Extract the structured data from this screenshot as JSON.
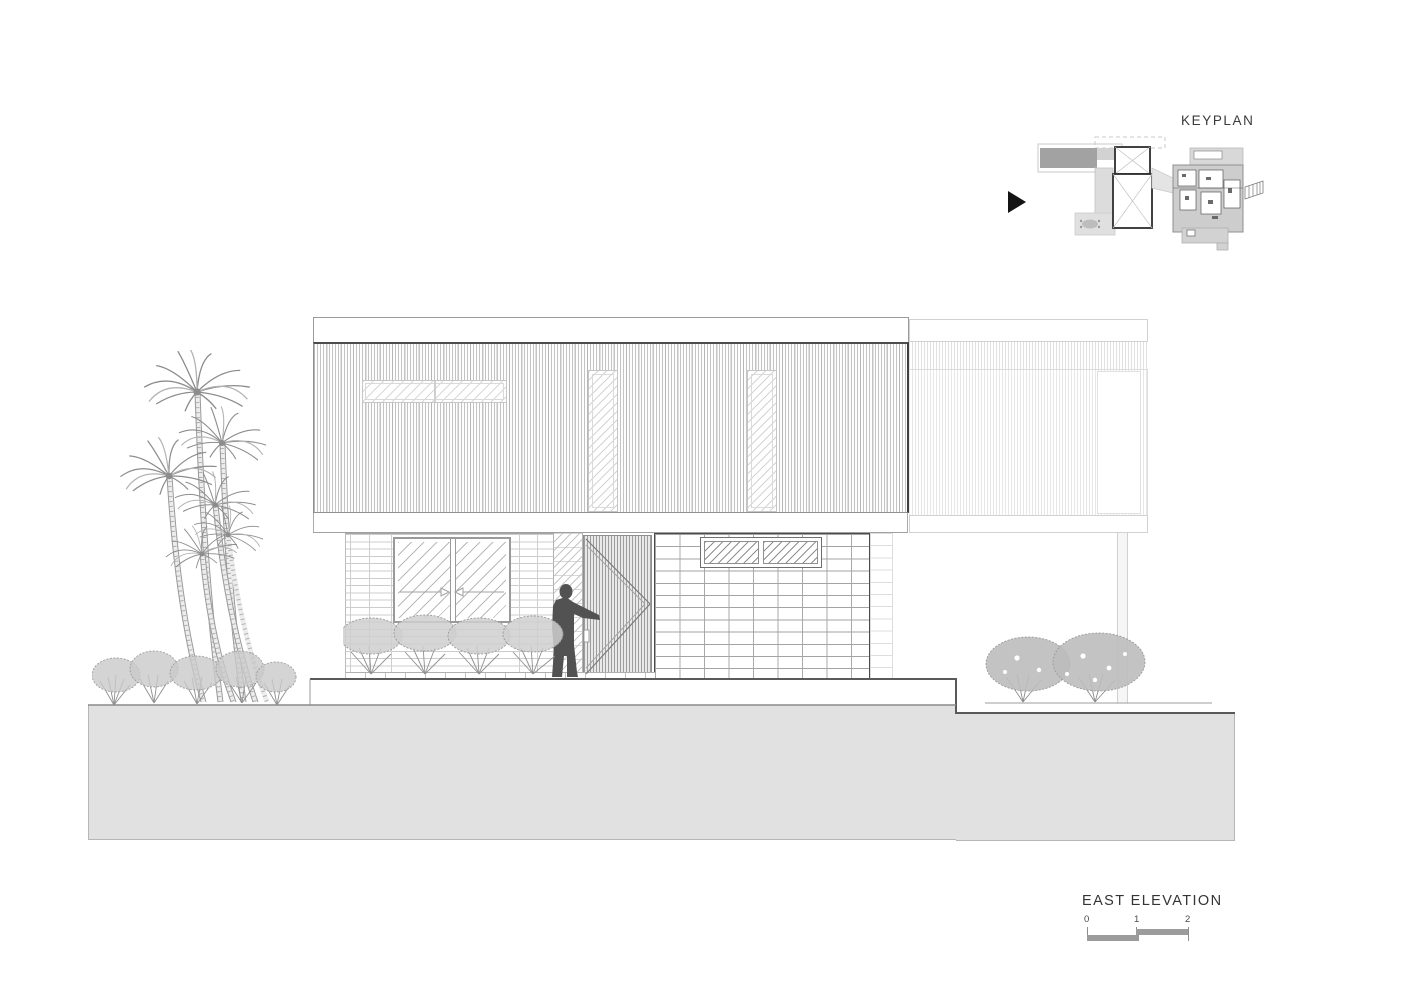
{
  "keyplan": {
    "title": "KEYPLAN",
    "marker_icon": "view-direction-triangle"
  },
  "elevation_label": {
    "title": "EAST ELEVATION"
  },
  "scale_bar": {
    "labels": [
      "0",
      "1",
      "2"
    ]
  },
  "colors": {
    "background": "#ffffff",
    "ground_fill": "#e1e1e1",
    "ground_profile": "#5a5a5a",
    "line_dark": "#3e3e3e",
    "line_mid": "#8f8f8f",
    "line_light": "#cfcfcf",
    "vegetation": "#9a9a9a",
    "person_silhouette": "#525252",
    "keyplan_gray": "#a2a2a2",
    "scale_bar_gray": "#9c9c9c"
  }
}
